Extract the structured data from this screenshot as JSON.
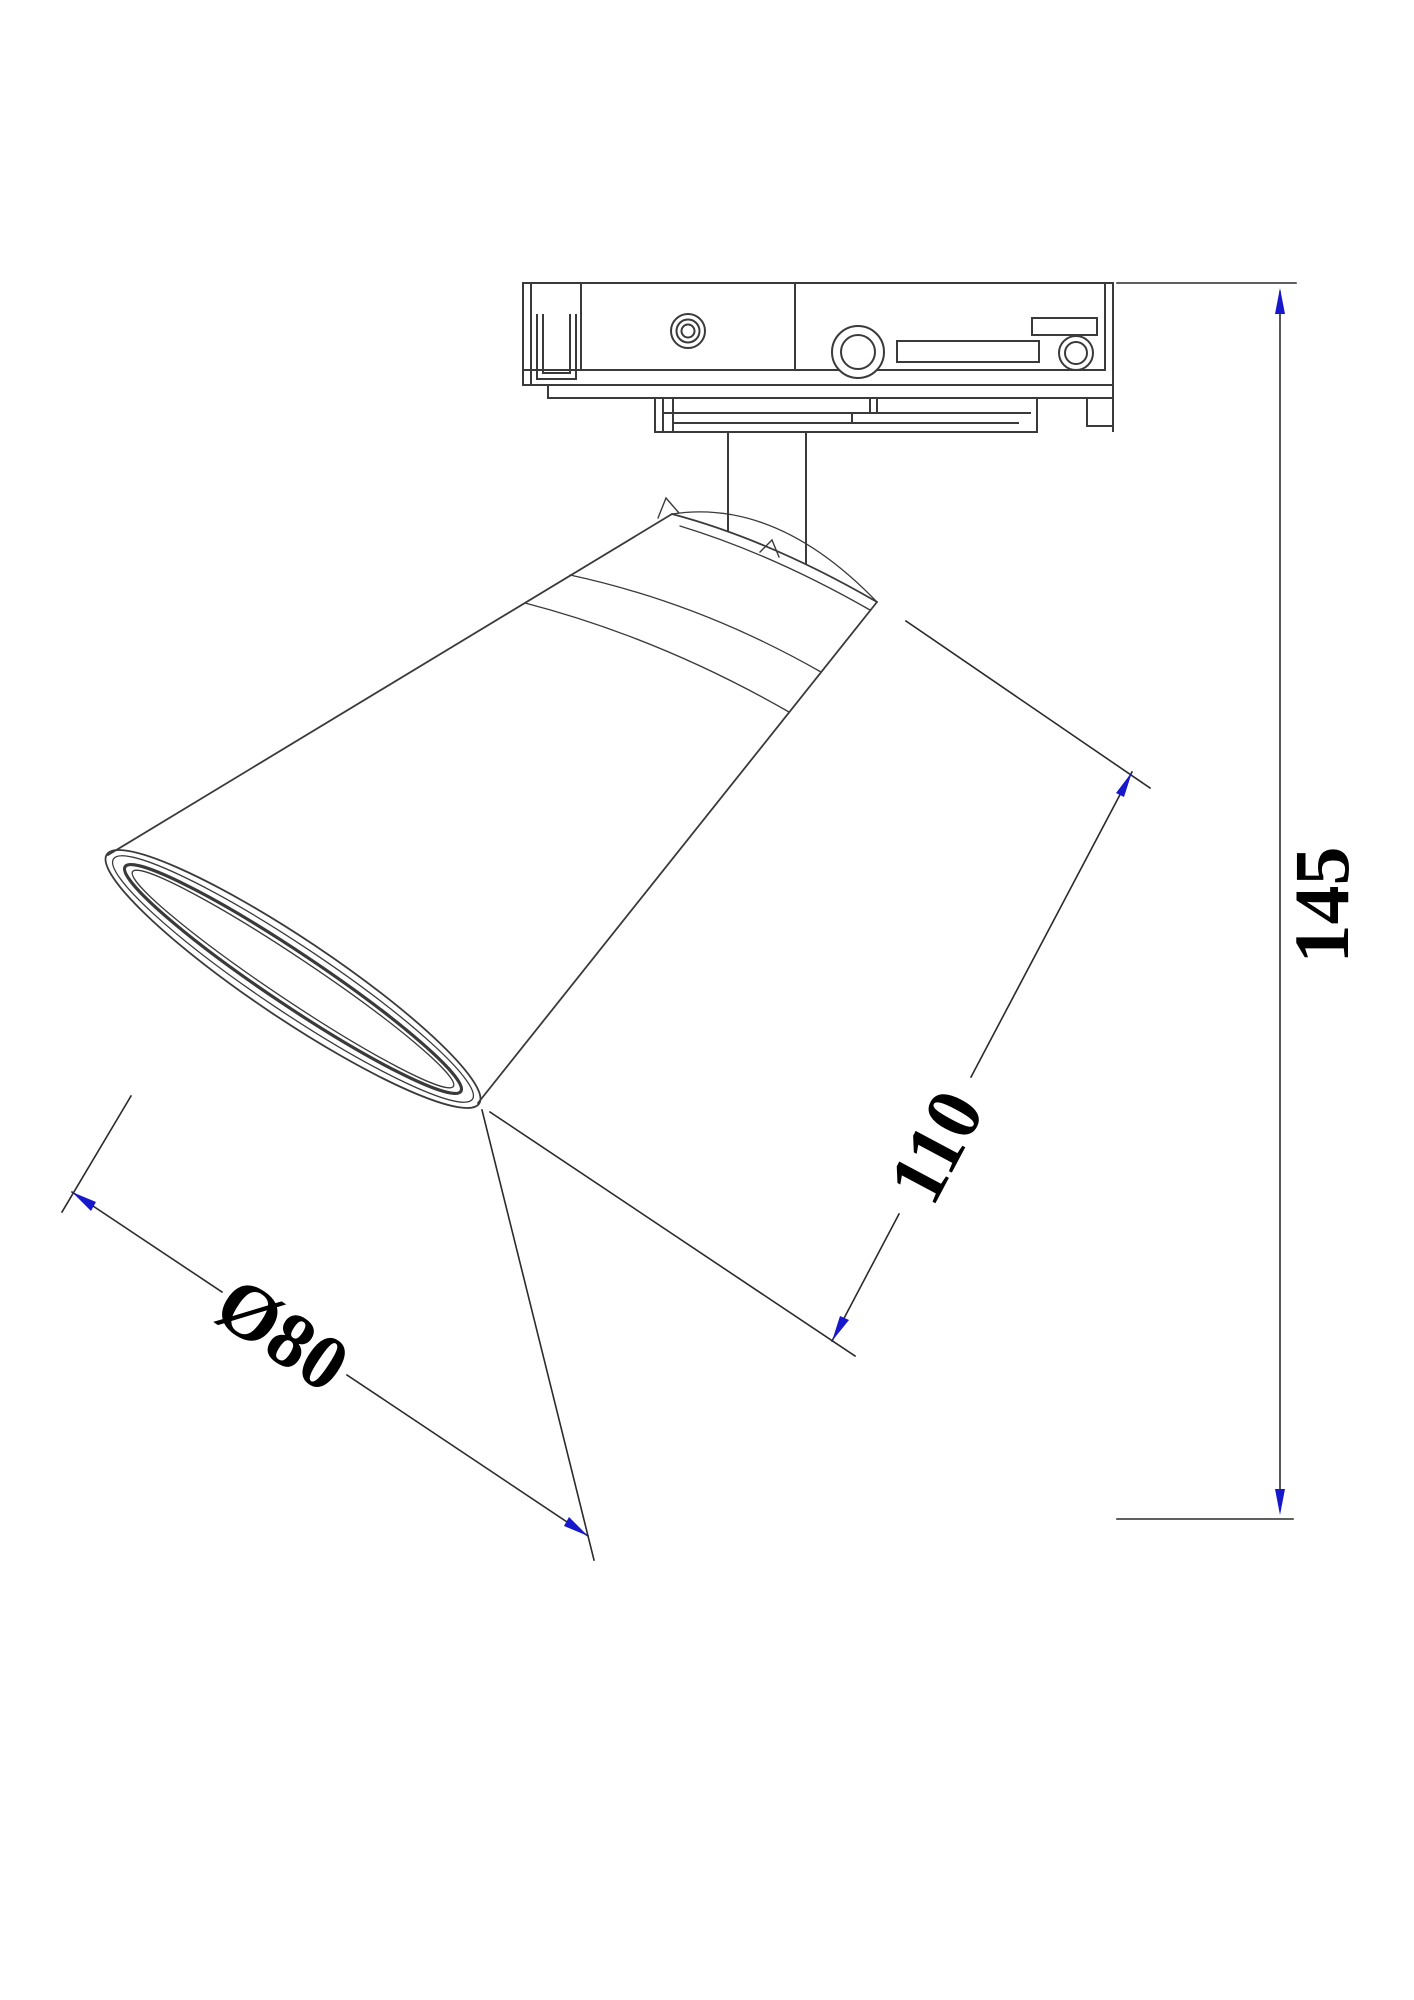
{
  "drawing": {
    "kind": "technical-line-drawing",
    "subject": "track-mounted spotlight, side view",
    "dimensions": [
      {
        "id": "overall-height",
        "label": "145"
      },
      {
        "id": "shade-length",
        "label": "110"
      },
      {
        "id": "shade-diameter",
        "label": "Ø80"
      }
    ],
    "colors": {
      "line": "#3a3a3a",
      "thin_line": "#4a4a4a",
      "dimension": "#2b2b2b",
      "arrowhead": "#1717cc",
      "label": "#000000",
      "background": "#ffffff"
    }
  }
}
